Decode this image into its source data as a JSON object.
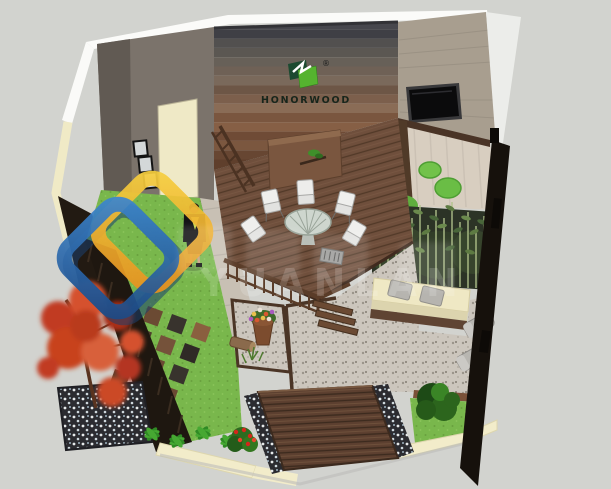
{
  "meta": {
    "type": "3d-garden-courtyard-design-render",
    "view": "isometric birds-eye SketchUp style",
    "canvas": {
      "width": 611,
      "height": 489
    },
    "background_color": "#d2d3cf"
  },
  "branding": {
    "name": "HONORWOOD",
    "registered_mark": "®",
    "logo_icon": "overlapping-green-squares-mark",
    "logo_colors": {
      "dark_green": "#1c4a30",
      "bright_green": "#55b32f",
      "text": "#17251b"
    }
  },
  "watermark": {
    "visible_letters": "YUANLAN",
    "icon": "interlocked-rounded-diamond-links",
    "colors": {
      "blue": "#2f6fb5",
      "navy": "#1c3f6d",
      "yellow": "#f6cf3e",
      "orange": "#e8901f"
    }
  },
  "scene": {
    "areas": [
      {
        "name": "back-wall",
        "desc": "horizontal WPC plank feature wall, grey fading to brown",
        "colors": [
          "#47474d",
          "#5f3f2c"
        ]
      },
      {
        "name": "left-wall",
        "desc": "taupe wall with cream door and three framed pictures",
        "wall": "#7b736b",
        "door": "#efe9c6"
      },
      {
        "name": "right-wall",
        "desc": "beige wall with wall-mounted flat screen TV",
        "wall": "#a89e8f",
        "tv": "#0d0d0d"
      },
      {
        "name": "main-deck",
        "desc": "raised brown composite deck with dining set and cabinet",
        "color": "#6f4f3c"
      },
      {
        "name": "dining-set",
        "desc": "round table with white chairs and small grill"
      },
      {
        "name": "person",
        "desc": "woman in dark suit standing on walkway"
      },
      {
        "name": "upper-patio",
        "desc": "light decking with round green moss shrubs",
        "color": "#d8cec0"
      },
      {
        "name": "bamboo-bed",
        "desc": "bamboo screen planting along right side"
      },
      {
        "name": "planter-bench",
        "desc": "cream planter bench with two grey cushions"
      },
      {
        "name": "sun-loungers",
        "desc": "two grey loungers beside right fence"
      },
      {
        "name": "stone-path",
        "desc": "grey paving with dark timber edging",
        "color": "#ccc6bd"
      },
      {
        "name": "gravel-bed",
        "desc": "gravel bed with flower pot, barrel and herbs"
      },
      {
        "name": "paver-lawn",
        "desc": "lawn with chequer timber paver tiles",
        "lawn": "#79b74c"
      },
      {
        "name": "red-maple",
        "desc": "red Japanese maple over dark pebble bed",
        "color": "#c13a20"
      },
      {
        "name": "front-platform",
        "desc": "low timber step platform flanked by black pebble strips",
        "color": "#5d4030"
      },
      {
        "name": "flower-bushes",
        "desc": "red flowering shrubs and leafy border plants"
      },
      {
        "name": "boundary",
        "desc": "dark timber fence and cream garden wall",
        "fence": "#16110c",
        "wall": "#f2ecca"
      }
    ]
  }
}
